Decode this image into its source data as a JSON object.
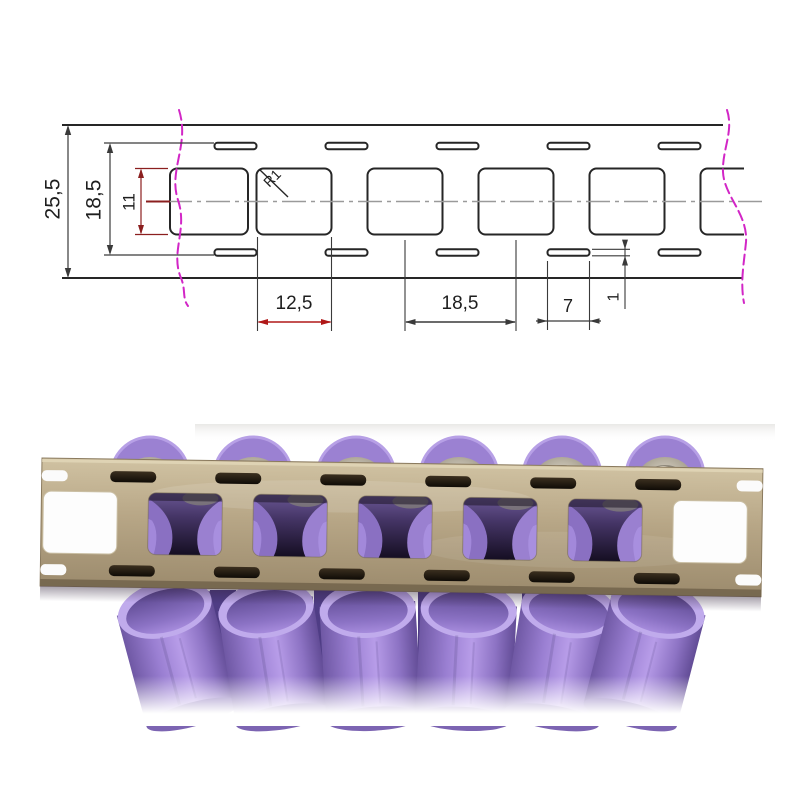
{
  "diagram": {
    "labels": {
      "total_width": "25,5",
      "slot_rows_span": "18,5",
      "hole_height": "11",
      "corner_radius": "R1",
      "hole_width": "12,5",
      "hole_pitch": "18,5",
      "slot_length": "7",
      "slot_thickness": "1"
    },
    "colors": {
      "outline": "#262626",
      "dimension_line": "#3a3a3a",
      "dimension_red": "#c02020",
      "dimension_dark_red": "#8b1f1f",
      "break_line_magenta": "#d226c6",
      "center_line_gray": "#9a9a9a"
    }
  },
  "photo": {
    "subject": "nickel strip on purple 18650 battery pack",
    "colors": {
      "strip_beige": "#b5a484",
      "strip_highlight": "#d2c4a4",
      "strip_shadow": "#6e6048",
      "battery_purple": "#9a7fd2",
      "battery_rim": "#c0abec",
      "metal_top": "#c9c2b4",
      "background": "#ffffff"
    }
  }
}
